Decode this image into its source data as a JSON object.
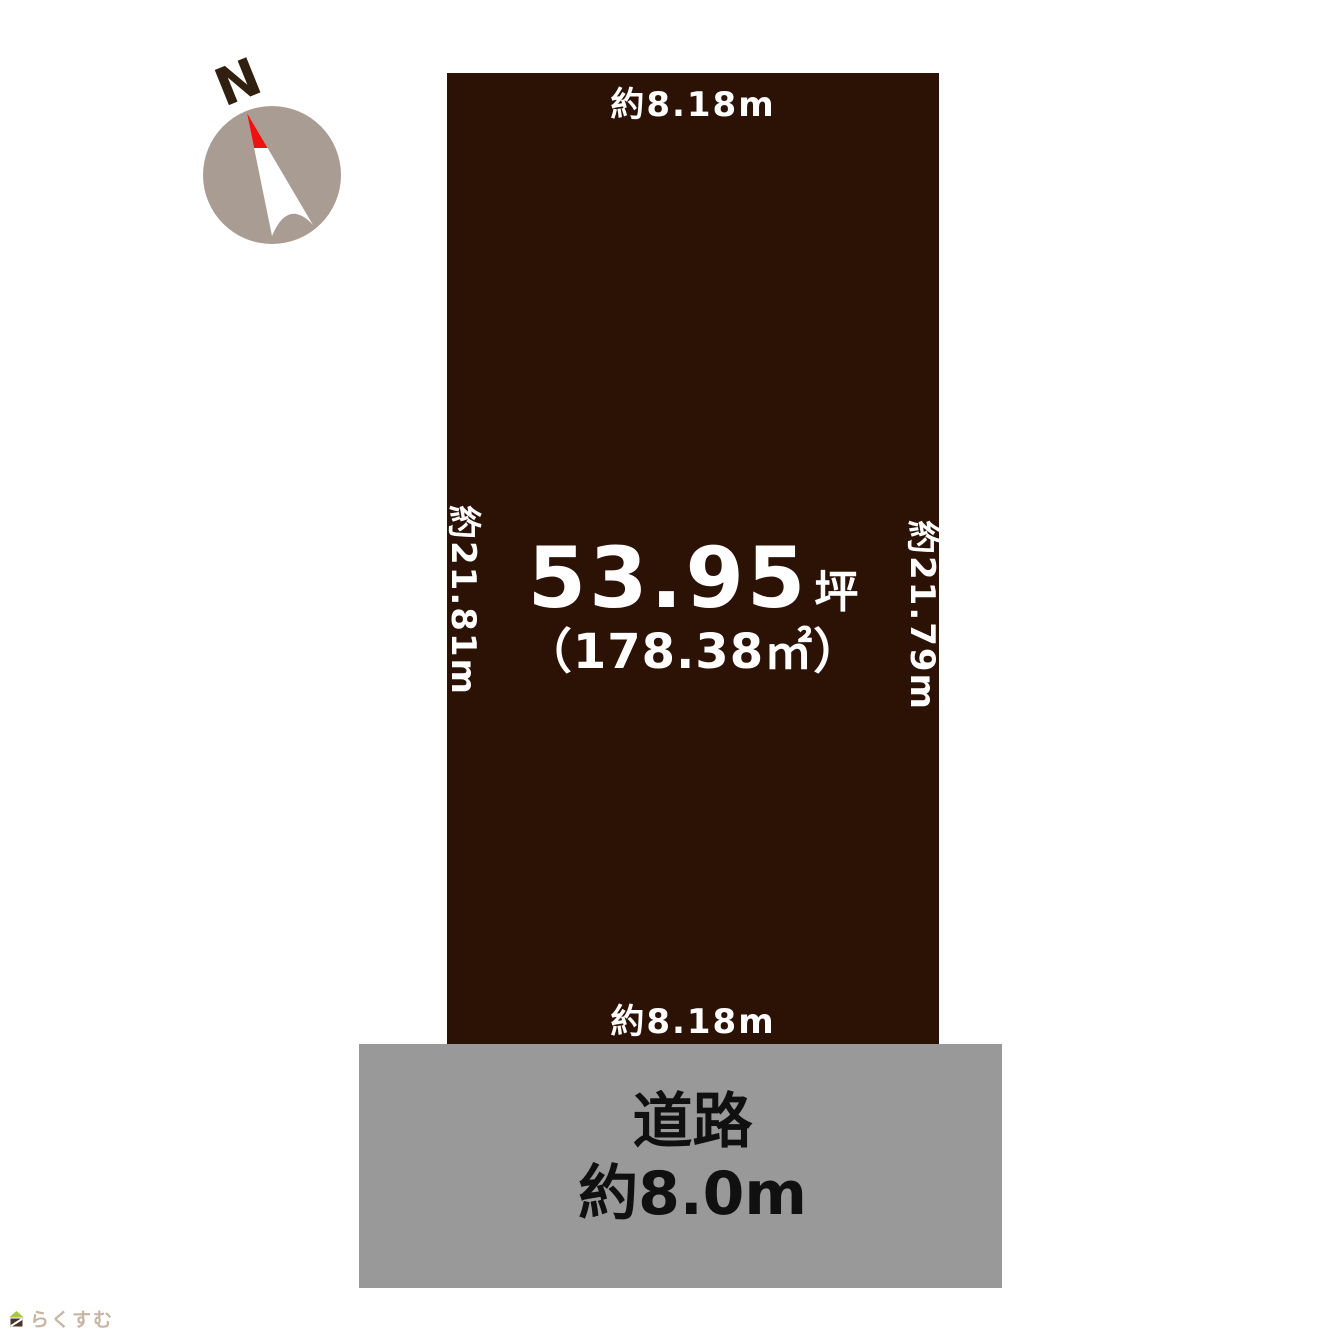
{
  "compass": {
    "north_label": "N",
    "circle_color": "#a99c93",
    "needle_color": "#ffffff",
    "needle_tip_color": "#ef1010",
    "north_label_color": "#31200f"
  },
  "plot": {
    "fill_color": "#2b1205",
    "text_color": "#ffffff",
    "dim_top": "約8.18m",
    "dim_bottom": "約8.18m",
    "dim_left": "約21.81m",
    "dim_right": "約21.79m",
    "area_tsubo": "53.95",
    "tsubo_unit": "坪",
    "area_sqm": "（178.38㎡）"
  },
  "road": {
    "fill_color": "#999999",
    "text_color": "#101010",
    "name": "道路",
    "width": "約8.0m"
  },
  "logo": {
    "text": "らくすむ",
    "roof_color": "#a8c93f",
    "base_color": "#4a3428"
  }
}
